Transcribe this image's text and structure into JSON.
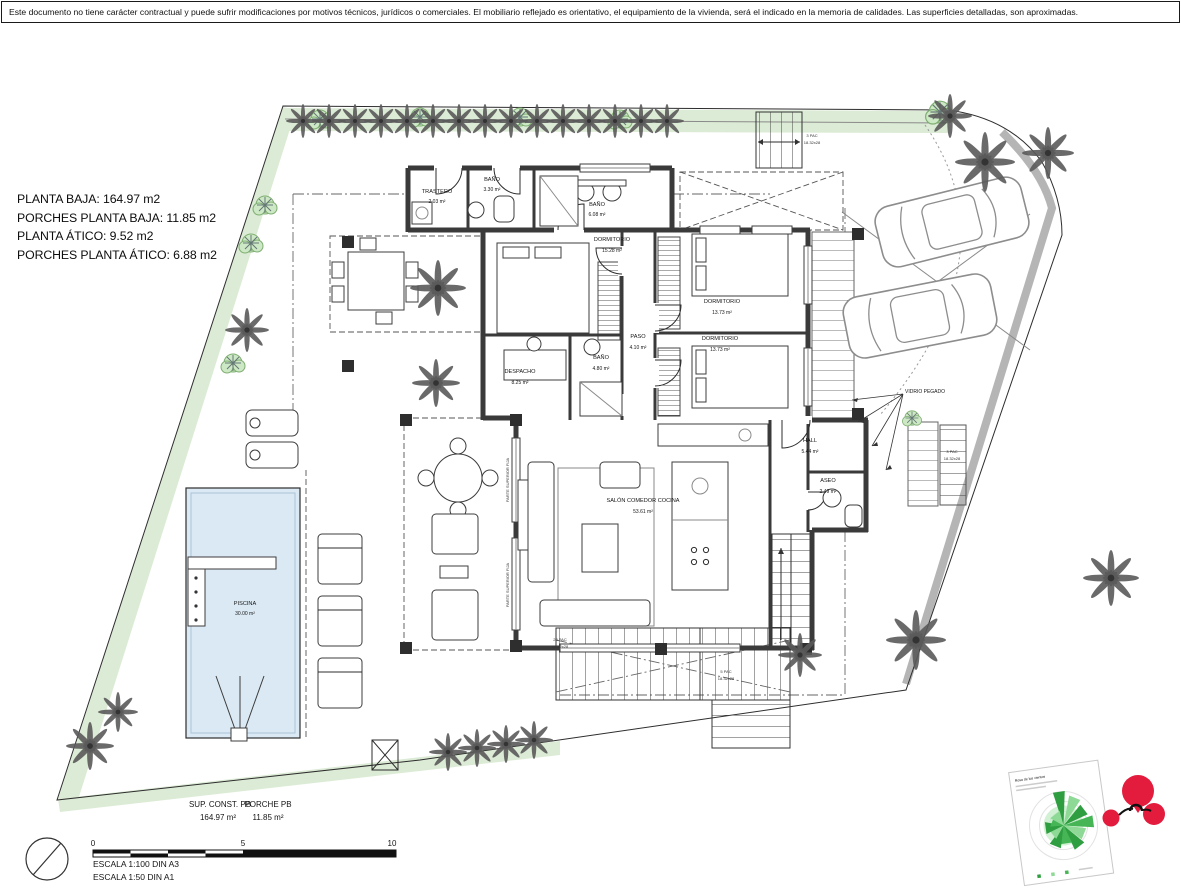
{
  "page": {
    "disclaimer": "Este documento no tiene carácter contractual y puede sufrir modificaciones por motivos técnicos, jurídicos o comerciales. El mobiliario reflejado es orientativo, el equipamiento de la vivienda, será el indicado en la memoria de calidades. Las superficies detalladas, son aproximadas."
  },
  "summary": {
    "line1": "PLANTA BAJA: 164.97 m2",
    "line2": "PORCHES PLANTA BAJA: 11.85 m2",
    "line3": "PLANTA ÁTICO: 9.52 m2",
    "line4": "PORCHES PLANTA ÁTICO: 6.88 m2"
  },
  "rooms": [
    {
      "name": "TRASTERO",
      "area": "2.03 m²"
    },
    {
      "name": "BAÑO",
      "area": "3.30 m²"
    },
    {
      "name": "BAÑO",
      "area": "6.08 m²"
    },
    {
      "name": "DORMITORIO",
      "area": "15.28 m²"
    },
    {
      "name": "DORMITORIO",
      "area": "13.73 m²"
    },
    {
      "name": "DORMITORIO",
      "area": "13.73 m²"
    },
    {
      "name": "PASO",
      "area": "4.10 m²"
    },
    {
      "name": "DESPACHO",
      "area": "8.25 m²"
    },
    {
      "name": "BAÑO",
      "area": "4.80 m²"
    },
    {
      "name": "HALL",
      "area": "5.44 m²"
    },
    {
      "name": "ASEO",
      "area": "2.49 m²"
    },
    {
      "name": "SALÓN COMEDOR COCINA",
      "area": "53.61 m²"
    },
    {
      "name": "PISCINA",
      "area": "30.00 m²"
    }
  ],
  "annotations": {
    "glass_note": "VIDRIO PEGADO",
    "stair_note_a1": "3 PAC",
    "stair_note_a2": "18.32x28",
    "stair_note_b1": "23 PAC",
    "stair_note_b2": "18.32x28",
    "stair_note_c1": "5 PAC",
    "stair_note_c2": "18.32x28",
    "stair_note_d1": "3 PAC",
    "stair_note_d2": "18.32x28",
    "window_note_1": "PARTE SUPERIOR FIJA",
    "window_note_2": "PARTE SUPERIOR FIJA"
  },
  "totals": {
    "const_label": "SUP. CONST. PB",
    "const_value": "164.97 m²",
    "porch_label": "PORCHE PB",
    "porch_value": "11.85 m²"
  },
  "scalebar": {
    "tick0": "0",
    "tick5": "5",
    "tick10": "10",
    "escala1": "ESCALA 1:100 DIN A3",
    "escala2": "ESCALA 1:50 DIN A1"
  },
  "windrose": {
    "title": "Rosa de los vientos"
  },
  "colors": {
    "wall": "#3a3a3a",
    "pool_fill": "#dbe9f4",
    "vegetation": "#dcebd5",
    "palm": "#5a5a5a",
    "curb": "#b5b5b5",
    "logo_red": "#e31b3d",
    "rose_dark_green": "#2f9e41",
    "rose_light_green": "#8fd996"
  }
}
